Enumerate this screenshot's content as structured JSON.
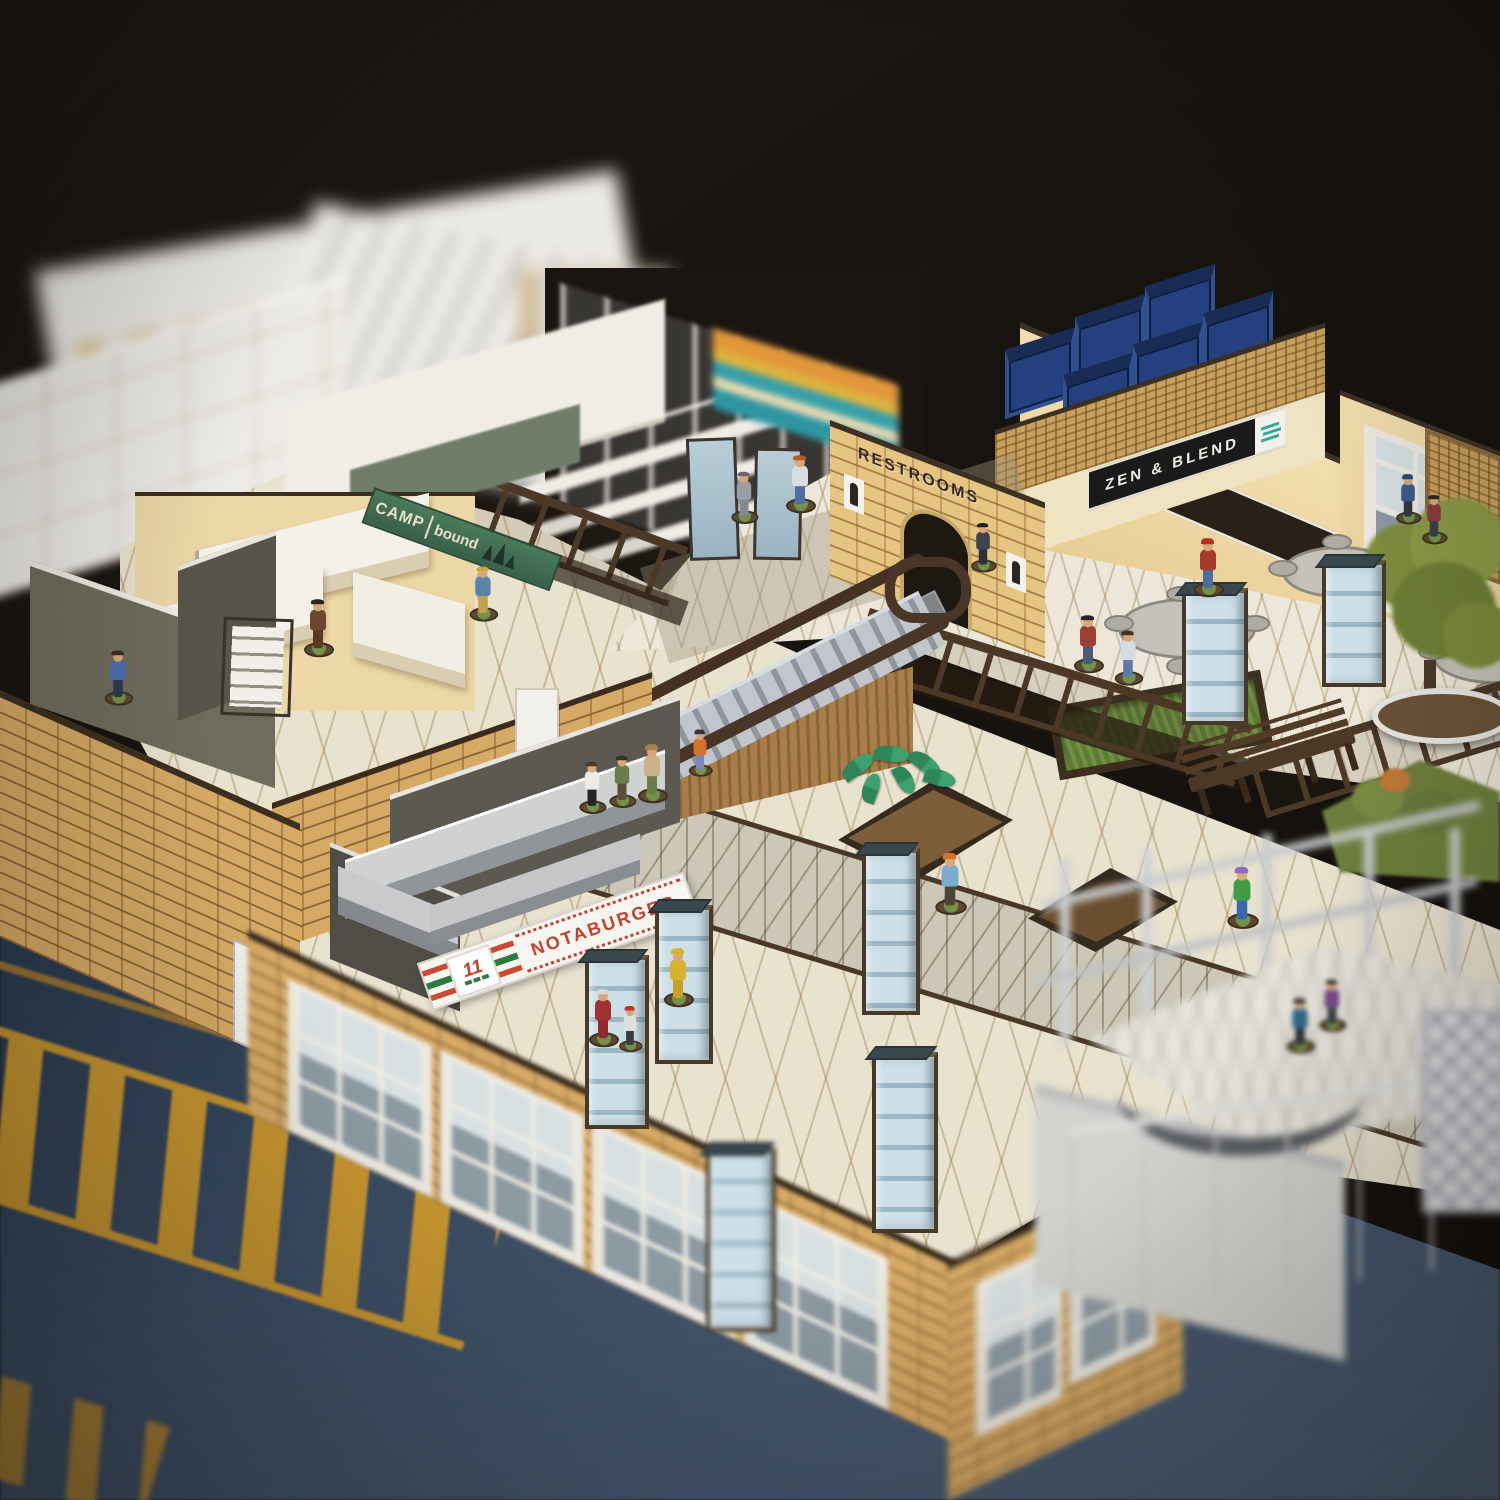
{
  "scene": {
    "description": "Overhead angled photo of a miniature tabletop shopping-mall terrain kit (laser-cut MDF) on a dark asphalt game mat with yellow parking markings, populated with painted 28mm miniature figures. Two-level mall interior with escalator, food court, shops and restrooms; foreground and background are out of focus."
  },
  "signs": {
    "camp": {
      "line1": "CAMP",
      "line2": "bound"
    },
    "notaburger": {
      "label": "NOTABURGER"
    },
    "eleven": {
      "label": "11"
    },
    "mall_management": {
      "label": "MALL MANAGEMENT"
    },
    "restrooms": {
      "label": "RESTROOMS"
    },
    "zen_blend": {
      "label": "ZEN & BLEND"
    }
  },
  "colors": {
    "brick_tan": "#d6a964",
    "brick_mortar": "#8a6335",
    "wall_peach": "#eed9a8",
    "floor_cream": "#e9e2cf",
    "walkway_grey": "#ccc7b6",
    "trim_dark_brown": "#44331f",
    "escalator_grey": "#c2c6cc",
    "glass_pillar_blue": "#c2d6e0",
    "bin_navy": "#24407e",
    "asphalt_blue": "#2e4158",
    "marking_yellow": "#cf9a2e",
    "camp_sign_green": "#44735a",
    "notaburger_red": "#c5402e",
    "stripe_green": "#2e7a44",
    "zen_sign_black": "#1a1a1a",
    "zen_icon_teal": "#2fa89a",
    "foliage_olive": "#7e8e3e"
  },
  "figures": [
    {
      "name": "office-worker-in-blue-suit",
      "x": 118,
      "y": 702,
      "s": 0.95,
      "shirt": "#4a6fb4",
      "pants": "#2f3a52",
      "hair": "#3a3026"
    },
    {
      "name": "woman-in-brown-coat",
      "x": 318,
      "y": 652,
      "s": 1.0,
      "shirt": "#6e4630",
      "pants": "#5a3826",
      "hair": "#2e2018"
    },
    {
      "name": "hiker-with-blue-backpack",
      "x": 483,
      "y": 618,
      "s": 0.95,
      "shirt": "#5b83ac",
      "pants": "#c2a24e",
      "hair": "#caa83a"
    },
    {
      "name": "woman-in-grey-dress",
      "x": 744,
      "y": 522,
      "s": 0.9,
      "shirt": "#9a9ea6",
      "pants": "#84888f",
      "hair": "#6a6468"
    },
    {
      "name": "janitor-in-blue-overalls",
      "x": 800,
      "y": 508,
      "s": 1.0,
      "shirt": "#d8dde2",
      "pants": "#4c6ea2",
      "hair": "#b05a2a"
    },
    {
      "name": "security-guard",
      "x": 592,
      "y": 812,
      "s": 0.9,
      "shirt": "#ecebe6",
      "pants": "#26262a",
      "hair": "#4a3a2a"
    },
    {
      "name": "soldier-in-olive",
      "x": 622,
      "y": 806,
      "s": 0.9,
      "shirt": "#6e7c4a",
      "pants": "#5c4e38",
      "hair": "#3a301e"
    },
    {
      "name": "cowgirl-with-hat",
      "x": 652,
      "y": 798,
      "s": 1.0,
      "shirt": "#cab286",
      "pants": "#6d7c48",
      "hat": "#a8824e"
    },
    {
      "name": "kid-in-orange-shirt",
      "x": 700,
      "y": 778,
      "s": 0.8,
      "shirt": "#d8702e",
      "pants": "#7a88b4",
      "hat": "#30364a"
    },
    {
      "name": "man-with-red-cap-on-pillar",
      "x": 1208,
      "y": 592,
      "s": 1.0,
      "shirt": "#a83a2c",
      "pants": "#4c6ea2",
      "hat": "#b03028"
    },
    {
      "name": "man-with-rifle-red-jacket",
      "x": 1088,
      "y": 668,
      "s": 1.0,
      "shirt": "#9c4034",
      "pants": "#4c5a78",
      "hair": "#2a2420"
    },
    {
      "name": "woman-in-white-vest",
      "x": 1128,
      "y": 682,
      "s": 0.95,
      "shirt": "#d4dce2",
      "pants": "#5c7aa4",
      "hair": "#3c342a"
    },
    {
      "name": "figure-at-restroom-door",
      "x": 983,
      "y": 572,
      "s": 0.85,
      "shirt": "#3c4452",
      "pants": "#2c3038",
      "hair": "#22201c"
    },
    {
      "name": "shopper-carrying-bags",
      "x": 950,
      "y": 908,
      "s": 1.05,
      "shirt": "#7caccc",
      "pants": "#4e4434",
      "hat": "#d8702e"
    },
    {
      "name": "elderly-lady-in-red-dress",
      "x": 603,
      "y": 1042,
      "s": 1.0,
      "shirt": "#9e3230",
      "pants": "#8e2c2c",
      "hair": "#d8d8d4"
    },
    {
      "name": "person-in-yellow-raincoat",
      "x": 678,
      "y": 1002,
      "s": 1.0,
      "shirt": "#d9b22c",
      "pants": "#c6a028",
      "hat": "#d9b22c"
    },
    {
      "name": "child-with-red-cap",
      "x": 630,
      "y": 1054,
      "s": 0.78,
      "shirt": "#e0e0dc",
      "pants": "#3c3c3e",
      "hat": "#c23430"
    },
    {
      "name": "runner-in-green-jacket",
      "x": 1242,
      "y": 922,
      "s": 1.05,
      "shirt": "#3f9e44",
      "pants": "#3a68aa",
      "hat": "#8a6cba"
    },
    {
      "name": "figure-on-entrance-platform",
      "x": 1300,
      "y": 1050,
      "s": 0.95,
      "shirt": "#2e6a8a",
      "pants": "#30343a",
      "hair": "#28241e",
      "blur": true
    },
    {
      "name": "figure-on-entrance-platform-2",
      "x": 1332,
      "y": 1030,
      "s": 0.9,
      "shirt": "#7a4a88",
      "pants": "#3c4048",
      "hair": "#2c2824",
      "blur": true
    },
    {
      "name": "figure-by-tree",
      "x": 1408,
      "y": 524,
      "s": 0.85,
      "shirt": "#3c5c8c",
      "pants": "#34383e",
      "hat": "#2c4a74"
    },
    {
      "name": "figure-by-tree-2",
      "x": 1434,
      "y": 544,
      "s": 0.85,
      "shirt": "#8c3c3c",
      "pants": "#3c4048",
      "hair": "#2a2622"
    }
  ],
  "glass_pillars": [
    {
      "x": 585,
      "y": 955,
      "w": 56,
      "h": 165,
      "z": 13
    },
    {
      "x": 655,
      "y": 905,
      "w": 50,
      "h": 150,
      "z": 13
    },
    {
      "x": 862,
      "y": 848,
      "w": 50,
      "h": 158,
      "z": 12
    },
    {
      "x": 872,
      "y": 1052,
      "w": 58,
      "h": 172,
      "z": 13
    },
    {
      "x": 706,
      "y": 1148,
      "w": 62,
      "h": 175,
      "z": 14,
      "blur": true
    },
    {
      "x": 1182,
      "y": 588,
      "w": 58,
      "h": 128,
      "z": 6
    },
    {
      "x": 1322,
      "y": 560,
      "w": 56,
      "h": 118,
      "z": 6
    }
  ],
  "food_court_tables": [
    {
      "x": 1118,
      "y": 598,
      "w": 132
    },
    {
      "x": 1282,
      "y": 546,
      "w": 110
    },
    {
      "x": 1432,
      "y": 628,
      "w": 118
    }
  ],
  "storage_bins": [
    {
      "x": 0,
      "y": 12
    },
    {
      "x": 70,
      "y": 2
    },
    {
      "x": 140,
      "y": -6
    },
    {
      "x": 58,
      "y": 56
    },
    {
      "x": 128,
      "y": 48
    },
    {
      "x": 198,
      "y": 40
    }
  ]
}
